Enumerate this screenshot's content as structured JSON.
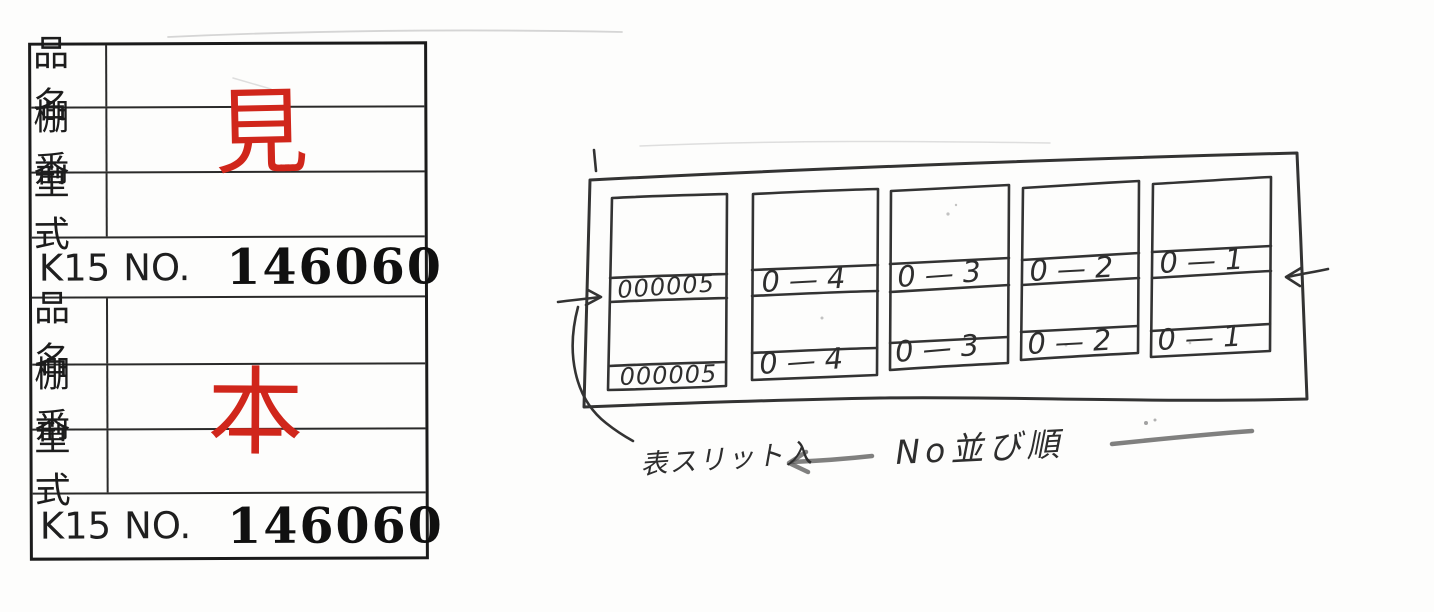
{
  "form": {
    "stamp_color": "#d0261b",
    "sections": [
      {
        "rows": [
          {
            "label": "品名",
            "value": ""
          },
          {
            "label": "棚番",
            "value": "見"
          },
          {
            "label": "型式",
            "value": ""
          }
        ],
        "code": "K15",
        "no_label": "NO.",
        "number": "146060"
      },
      {
        "rows": [
          {
            "label": "品名",
            "value": ""
          },
          {
            "label": "棚番",
            "value": "本"
          },
          {
            "label": "型式",
            "value": ""
          }
        ],
        "code": "K15",
        "no_label": "NO.",
        "number": "146060"
      }
    ]
  },
  "sketch": {
    "ink_color": "#333333",
    "boxes": [
      {
        "middle_label": "000005",
        "bottom_label": "000005"
      },
      {
        "middle_label": "0—4",
        "bottom_label": "0—4"
      },
      {
        "middle_label": "0—3",
        "bottom_label": "0—3"
      },
      {
        "middle_label": "0—2",
        "bottom_label": "0—2"
      },
      {
        "middle_label": "0—1",
        "bottom_label": "0—1"
      }
    ],
    "annotations": {
      "slit_note": "表スリット入",
      "order_note": "No並び順"
    },
    "arrows": {
      "left": "→",
      "right": "←",
      "note_arrow": "←",
      "dash": "—"
    }
  }
}
